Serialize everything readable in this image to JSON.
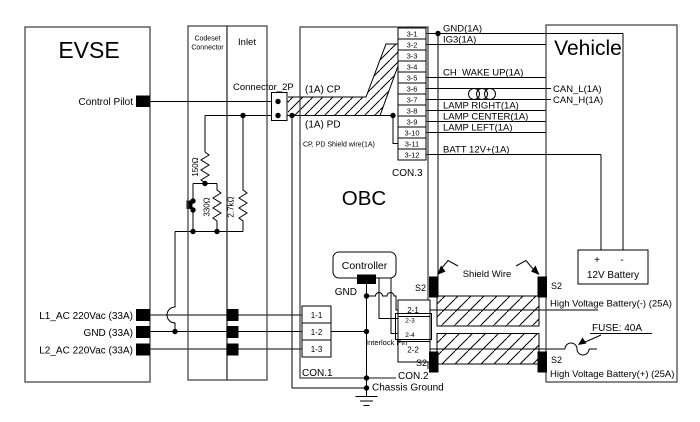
{
  "evse": {
    "title": "EVSE",
    "control_pilot": "Control Pilot",
    "l1": "L1_AC 220Vac (33A)",
    "gnd": "GND (33A)",
    "l2": "L2_AC 220Vac (33A)"
  },
  "codeset": {
    "name_line1": "Codeset",
    "name_line2": "Connector",
    "r_150": "150Ω",
    "r_330": "330Ω",
    "r_2k7": "2.7kΩ"
  },
  "inlet": {
    "title": "Inlet",
    "connector_2p": "Connector_2P"
  },
  "obc": {
    "title": "OBC",
    "cp_label": "(1A) CP",
    "pd_label": "(1A) PD",
    "shield_label": "CP, PD Shield wire(1A)",
    "controller": "Controller",
    "controller_gnd": "GND",
    "interlock": "Interlock Pin",
    "chassis_ground": "Chassis Ground",
    "s2": "S2",
    "con1": {
      "label": "CON.1",
      "pins": [
        "1-1",
        "1-2",
        "1-3"
      ]
    },
    "con2": {
      "label": "CON.2",
      "pins": [
        "2-1",
        "2-3",
        "2-4",
        "2-2"
      ]
    },
    "con3": {
      "label": "CON.3",
      "pins": [
        "3-1",
        "3-2",
        "3-3",
        "3-4",
        "3-5",
        "3-6",
        "3-7",
        "3-8",
        "3-9",
        "3-10",
        "3-11",
        "3-12"
      ]
    }
  },
  "signals": {
    "gnd": "GND(1A)",
    "ig3": "IG3(1A)",
    "ch_wake_up": "CH_WAKE UP(1A)",
    "can_l": "CAN_L(1A)",
    "can_h": "CAN_H(1A)",
    "lamp_right": "LAMP RIGHT(1A)",
    "lamp_center": "LAMP CENTER(1A)",
    "lamp_left": "LAMP LEFT(1A)",
    "batt_12v": "BATT 12V+(1A)",
    "shield_wire": "Shield Wire"
  },
  "vehicle": {
    "title": "Vehicle",
    "s2": "S2",
    "battery_label": "12V Battery",
    "battery_plus": "+",
    "battery_minus": "-",
    "hv_neg": "High Voltage Battery(-) (25A)",
    "hv_pos": "High Voltage Battery(+) (25A)",
    "fuse": "FUSE: 40A"
  }
}
